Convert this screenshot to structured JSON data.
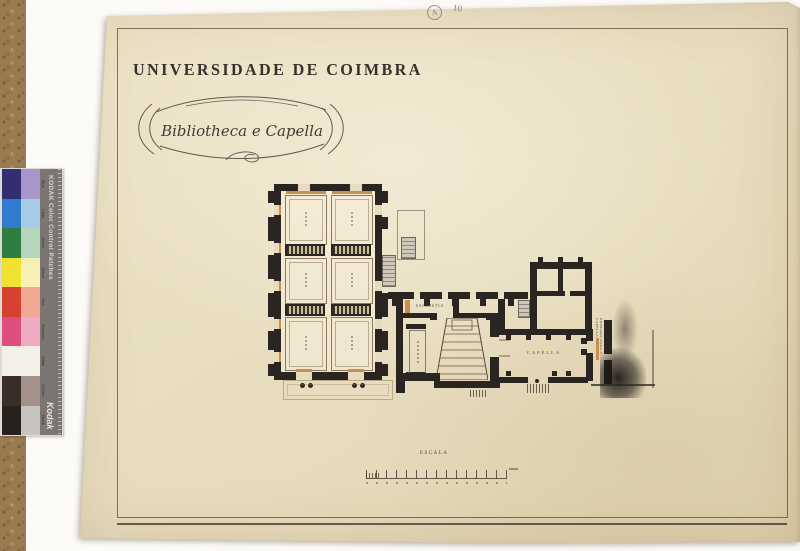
{
  "scan": {
    "pencil_annotations": {
      "circled_letter": "A",
      "number": "10"
    }
  },
  "drawing": {
    "title": "UNIVERSIDADE DE COIMBRA",
    "cartouche": "Bibliotheca e Capella",
    "rooms": {
      "capella": "CAPELLA",
      "sacristia": "SACRISTIA",
      "entrada_vertical": "ENTRADA PARA A CAPELLA"
    },
    "scale_label": "ESCALA"
  },
  "kodak_strip": {
    "title": "KODAK Color Control Patches",
    "brand": "Kodak",
    "patches": [
      {
        "label": "Blue",
        "color": "#332d72",
        "tint": "#a795cb"
      },
      {
        "label": "Cyan",
        "color": "#2f7ccf",
        "tint": "#a6cce8"
      },
      {
        "label": "Green",
        "color": "#2f7e41",
        "tint": "#b5d6ba"
      },
      {
        "label": "Yellow",
        "color": "#f0e32f",
        "tint": "#f6f0b4"
      },
      {
        "label": "Red",
        "color": "#d64130",
        "tint": "#f2a793"
      },
      {
        "label": "Magenta",
        "color": "#dd4d7e",
        "tint": "#edaac1"
      },
      {
        "label": "White",
        "color": "#f2f0e9",
        "tint": "#f2f0e9"
      },
      {
        "label": "3/Color",
        "color": "#3a2e29",
        "tint": "#a3918a"
      },
      {
        "label": "Black",
        "color": "#26211f",
        "tint": "#c7c3bf"
      }
    ],
    "colors": {
      "bar": "#7b7672",
      "text": "#d8d5d1"
    }
  },
  "colors": {
    "paper": "#e9dec3",
    "ink": "#2a2521",
    "ochre": "#cd8d4c",
    "pencil": "#8d8578",
    "cork": "#9a7b50",
    "background": "#fbfaf7"
  }
}
